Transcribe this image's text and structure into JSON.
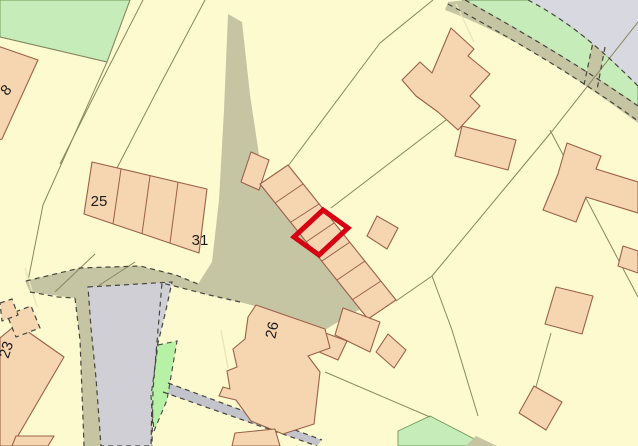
{
  "map": {
    "kind": "cadastral-planning-map",
    "description": "Ordnance-Survey style site location map with a plot highlighted in red"
  },
  "labels": {
    "plot_8": "8",
    "terrace_left": "25",
    "terrace_right": "31",
    "house_26": "26",
    "house_23": "23"
  },
  "colors": {
    "background": "#FDFACF",
    "building": "#F6D5B1",
    "building_outline": "#9A614A",
    "parcel_line": "#8A8760",
    "pale_line": "#EAE6BA",
    "track": "#C5C4A3",
    "road_grey": "#CFCFD5",
    "road_grey_light": "#D8D8E0",
    "road_grey_dark": "#C3C3CB",
    "green": "#C6ECBA",
    "green_bright": "#B6F1A5",
    "green_outline": "#6F9A55",
    "dash": "#46463E",
    "plot_highlight": "#D60012",
    "label_text": "#1C1C1C"
  }
}
